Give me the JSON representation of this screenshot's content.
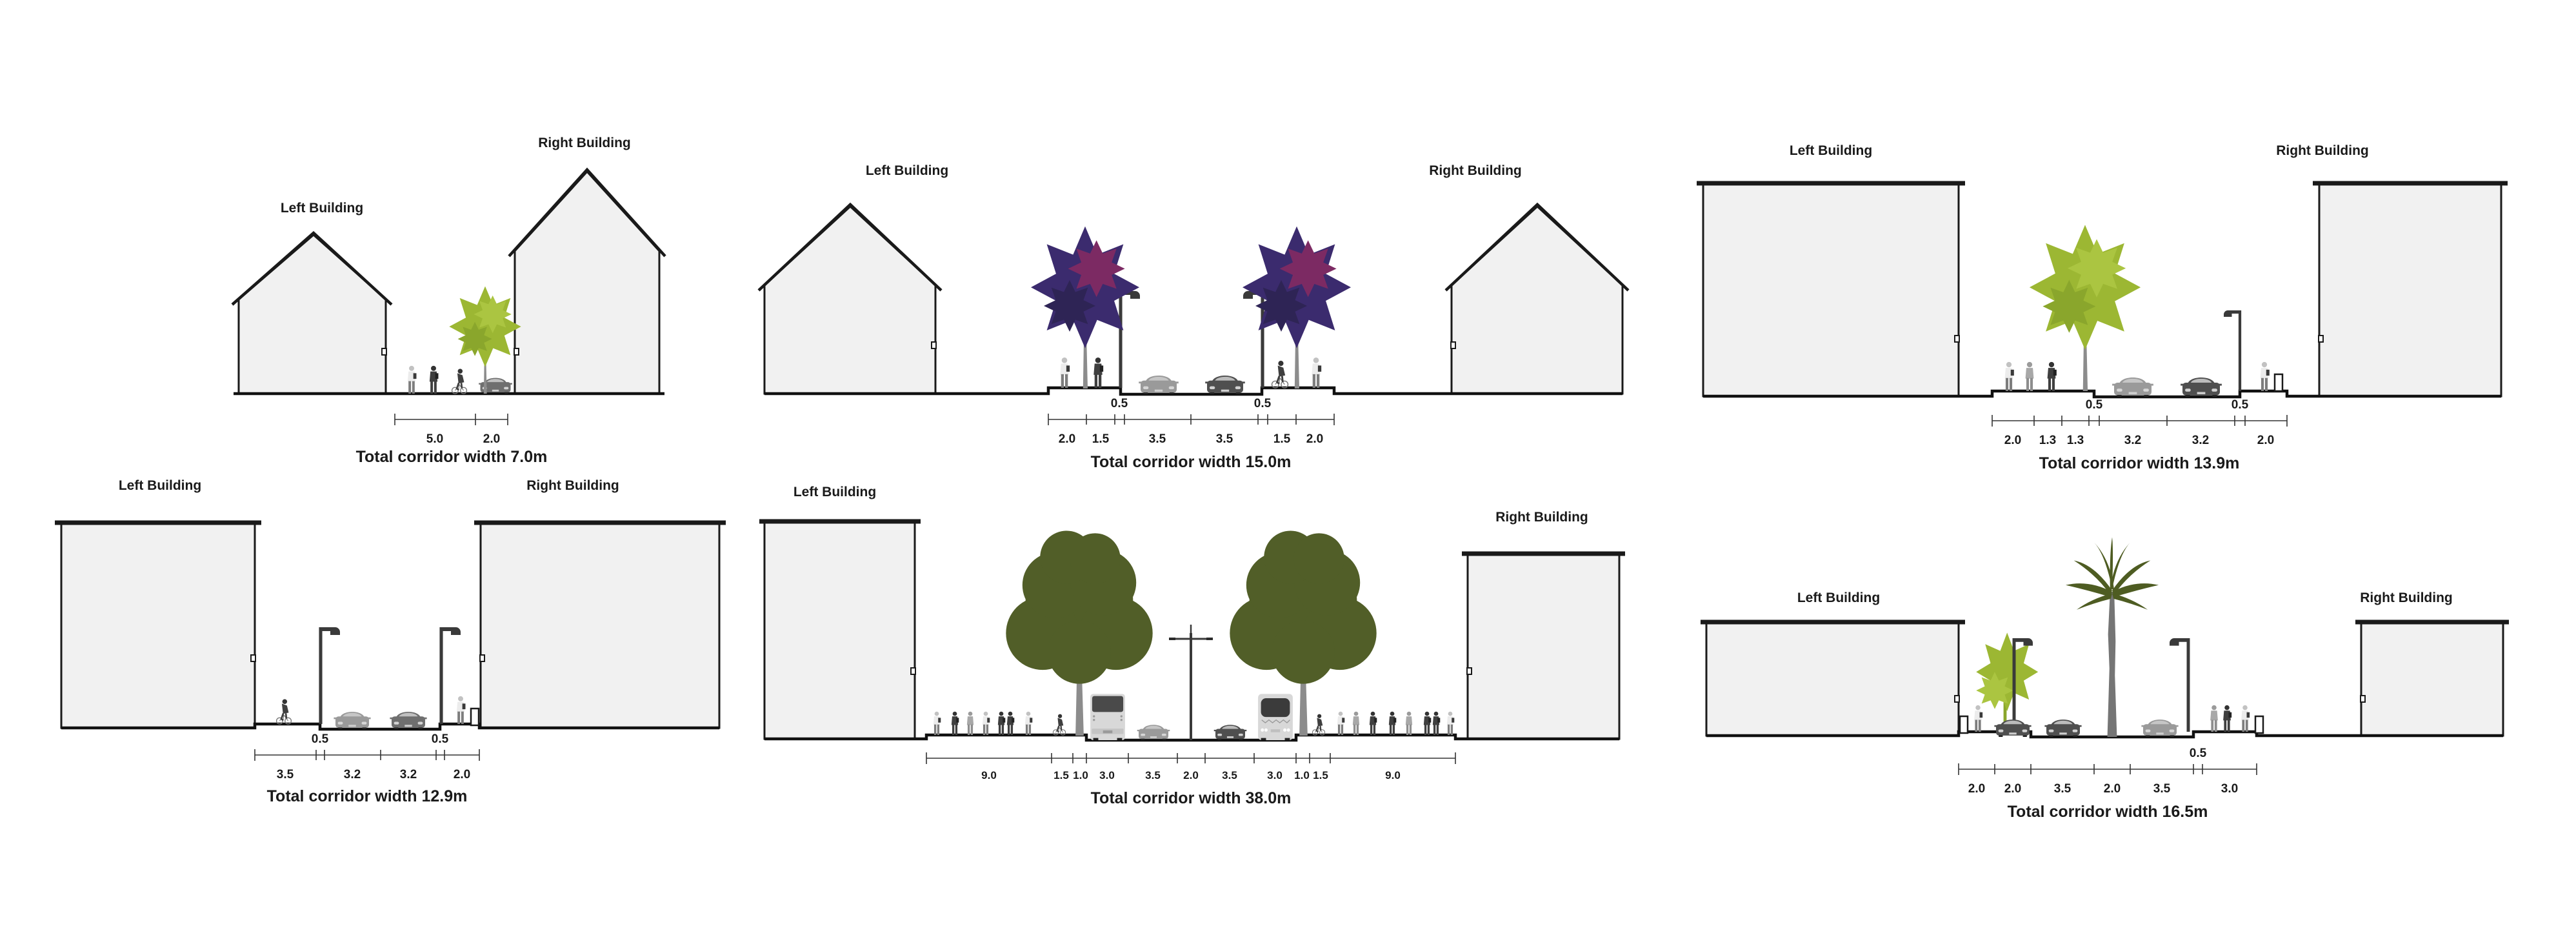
{
  "diagram": {
    "type": "street-cross-sections",
    "rows": 2,
    "columns": 3
  },
  "colors": {
    "background": "#ffffff",
    "building_fill": "#f1f1f1",
    "outline": "#1a1a1a",
    "lime_tree": "#9cb733",
    "purple_tree": "#3b2b6e",
    "magenta_tree": "#7c2a63",
    "olive_tree": "#515e28",
    "palm_tree": "#4e5c22",
    "trunk": "#8c8c8c",
    "car_light": "#9a9a9a",
    "car_dark": "#4f4f4f",
    "bus_body": "#d8d8d8",
    "lamp_post": "#3a3a3a"
  },
  "panels": [
    {
      "left_label": "Left Building",
      "right_label": "Right Building",
      "dims": [
        "5.0",
        "2.0"
      ],
      "buffers": [],
      "total": "Total corridor width 7.0m",
      "total_width_m": 7.0,
      "segments_m": [
        5.0,
        2.0
      ]
    },
    {
      "left_label": "Left Building",
      "right_label": "Right Building",
      "dims": [
        "2.0",
        "1.5",
        "3.5",
        "3.5",
        "1.5",
        "2.0"
      ],
      "buffers": [
        "0.5",
        "0.5"
      ],
      "total": "Total corridor width 15.0m",
      "total_width_m": 15.0,
      "segments_m": [
        2.0,
        1.5,
        0.5,
        3.5,
        3.5,
        0.5,
        1.5,
        2.0
      ]
    },
    {
      "left_label": "Left Building",
      "right_label": "Right Building",
      "dims": [
        "2.0",
        "1.3",
        "1.3",
        "3.2",
        "3.2",
        "2.0"
      ],
      "buffers": [
        "0.5",
        "0.5"
      ],
      "total": "Total corridor width 13.9m",
      "total_width_m": 13.9,
      "segments_m": [
        2.0,
        1.3,
        1.3,
        0.5,
        3.2,
        3.2,
        0.5,
        2.0
      ]
    },
    {
      "left_label": "Left Building",
      "right_label": "Right Building",
      "dims": [
        "3.5",
        "3.2",
        "3.2",
        "2.0"
      ],
      "buffers": [
        "0.5",
        "0.5"
      ],
      "total": "Total corridor width 12.9m",
      "total_width_m": 12.9,
      "segments_m": [
        3.5,
        0.5,
        3.2,
        3.2,
        0.5,
        2.0
      ]
    },
    {
      "left_label": "Left Building",
      "right_label": "Right Building",
      "dims": [
        "9.0",
        "1.5",
        "1.0",
        "3.0",
        "3.5",
        "2.0",
        "3.5",
        "3.0",
        "1.0",
        "1.5",
        "9.0"
      ],
      "buffers": [],
      "total": "Total corridor width 38.0m",
      "total_width_m": 38.0,
      "segments_m": [
        9.0,
        1.5,
        1.0,
        3.0,
        3.5,
        2.0,
        3.5,
        3.0,
        1.0,
        1.5,
        9.0
      ]
    },
    {
      "left_label": "Left Building",
      "right_label": "Right Building",
      "dims": [
        "2.0",
        "2.0",
        "3.5",
        "2.0",
        "3.5",
        "3.0"
      ],
      "buffers": [
        "0.5"
      ],
      "total": "Total corridor width 16.5m",
      "total_width_m": 16.5,
      "segments_m": [
        2.0,
        2.0,
        3.5,
        2.0,
        3.5,
        0.5,
        3.0
      ]
    }
  ]
}
